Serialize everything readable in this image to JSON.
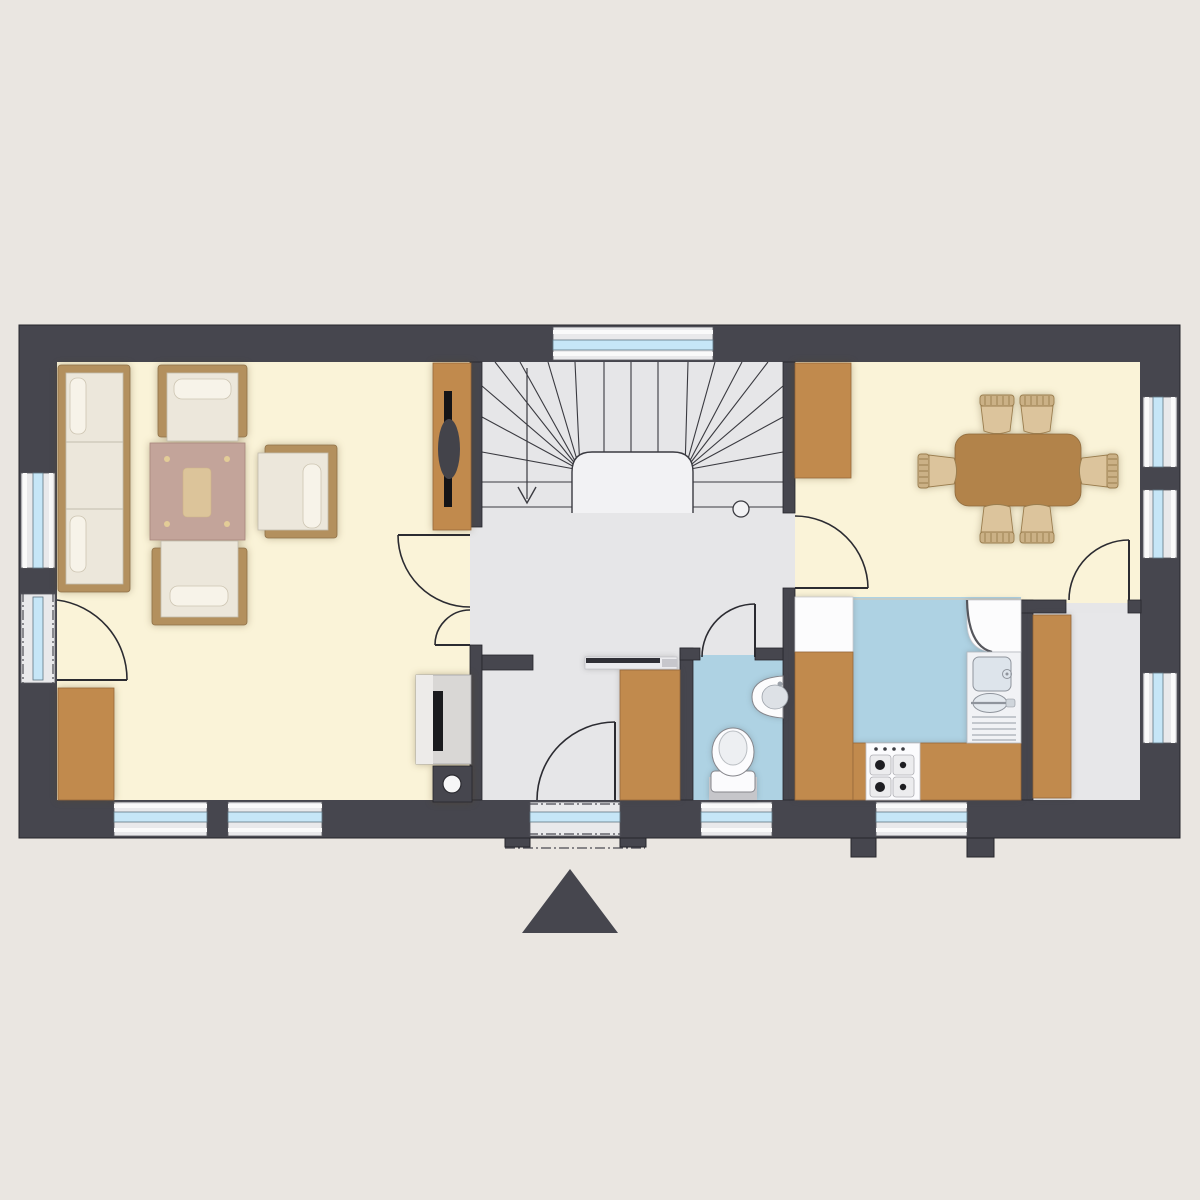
{
  "document": {
    "kind": "floor-plan",
    "view": "top-down",
    "visible_text": [],
    "entrance_marker": "solid-triangle-below-plan"
  },
  "colors": {
    "background": "#eae6e1",
    "wall": "#46464e",
    "wallLine": "#26262c",
    "floorLiving": "#faf3d8",
    "floorHall": "#e6e6e8",
    "floorWet": "#aed2e3",
    "floorStorage": "#e7e7e9",
    "windowFrame": "#e9e9eb",
    "windowGlass": "#c6e6f7",
    "windowLine": "#5f7683",
    "wood": "#c18a4d",
    "woodLine": "#96683a",
    "sofaFrame": "#b3905e",
    "cushion": "#ece7db",
    "cushionLine": "#c2bcae",
    "tableWood": "#b2834a",
    "chairSeat": "#dcc49c",
    "chairBack": "#cbb186",
    "chairLine": "#9a7d4e",
    "applianceWhite": "#fcfcfd",
    "applianceLine": "#c9c9cf",
    "fixtureLine": "#85858b",
    "steel": "#dde4eb",
    "stoveBlack": "#1b1b1e",
    "stairLine": "#3a3a40",
    "voidFill": "#f2f2f4",
    "doorLine": "#2b2b31",
    "tablePink": "#c3a49a",
    "tablePinkCenter": "#dcc49a"
  },
  "legend": {
    "rooms": [
      {
        "id": "living-room",
        "floor": "floorLiving",
        "furniture": [
          "three-seat-sofa",
          "armchair-top",
          "armchair-bottom",
          "armchair-right",
          "coffee-table",
          "tv-lowboard",
          "sideboard",
          "wood-stove",
          "chimney"
        ]
      },
      {
        "id": "hallway-staircase",
        "floor": "floorHall",
        "furniture": [
          "coat-rack",
          "wardrobe"
        ],
        "features": [
          "u-winder-staircase",
          "walk-line-arrow",
          "newel-post",
          "entrance-door"
        ]
      },
      {
        "id": "wc",
        "floor": "floorWet",
        "furniture": [
          "washbasin",
          "toilet"
        ]
      },
      {
        "id": "kitchen",
        "floor": "floorWet",
        "furniture": [
          "tall-unit",
          "counter-left",
          "counter-bottom",
          "corner-unit",
          "sink",
          "stove-4-burner"
        ]
      },
      {
        "id": "dining-room",
        "floor": "floorLiving",
        "furniture": [
          "sideboard",
          "dining-table",
          "chair",
          "chair",
          "chair",
          "chair",
          "chair",
          "chair"
        ]
      },
      {
        "id": "storage-room",
        "floor": "floorStorage",
        "furniture": [
          "tall-cabinet"
        ]
      }
    ],
    "window_count": 9,
    "exterior_glazed_doors": 2,
    "interior_doors": 4
  }
}
